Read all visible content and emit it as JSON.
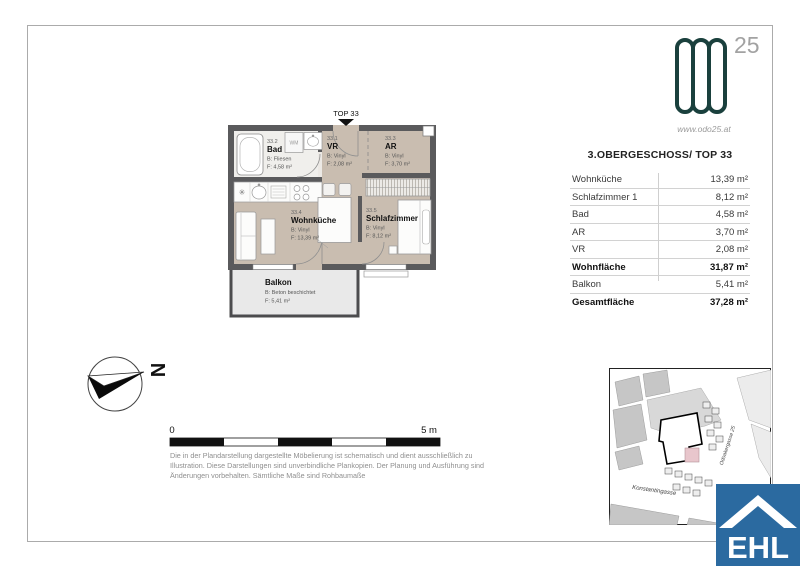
{
  "floorplan": {
    "entrance_label": "TOP 33",
    "rooms": {
      "bad": {
        "number": "33.2",
        "name": "Bad",
        "floor": "B: Fliesen",
        "area": "F: 4,58 m²"
      },
      "vr": {
        "number": "33.1",
        "name": "VR",
        "floor": "B: Vinyl",
        "area": "F: 2,08 m²"
      },
      "ar": {
        "number": "33.3",
        "name": "AR",
        "floor": "B: Vinyl",
        "area": "F: 3,70 m²"
      },
      "wohnkueche": {
        "number": "33.4",
        "name": "Wohnküche",
        "floor": "B: Vinyl",
        "area": "F: 13,39 m²"
      },
      "schlafzimmer": {
        "number": "33.5",
        "name": "Schlafzimmer",
        "floor": "B: Vinyl",
        "area": "F: 8,12 m²"
      },
      "balkon": {
        "name": "Balkon",
        "floor": "B: Beton beschichtet",
        "area": "F: 5,41 m²"
      }
    },
    "labels": {
      "wm": "WM"
    }
  },
  "brand": {
    "number": "25",
    "website": "www.odo25.at",
    "color": "#1a403d"
  },
  "area_table": {
    "title": "3.OBERGESCHOSS/ TOP 33",
    "rows": [
      {
        "name": "Wohnküche",
        "value": "13,39 m²"
      },
      {
        "name": "Schlafzimmer 1",
        "value": "8,12 m²"
      },
      {
        "name": "Bad",
        "value": "4,58 m²"
      },
      {
        "name": "AR",
        "value": "3,70 m²"
      },
      {
        "name": "VR",
        "value": "2,08 m²"
      },
      {
        "name": "Wohnfläche",
        "value": "31,87 m²"
      },
      {
        "name": "Balkon",
        "value": "5,41 m²"
      },
      {
        "name": "Gesamtfläche",
        "value": "37,28 m²"
      }
    ]
  },
  "compass": {
    "north": "N"
  },
  "scale_bar": {
    "start": "0",
    "end": "5 m"
  },
  "disclaimer": {
    "text": "Die in der Plandarstellung dargestellte Möbelierung ist schematisch und dient ausschließlich zu Illustration. Diese Darstellungen sind unverbindliche Plankopien. Der Planung und Ausführung sind Änderungen vorbehalten. Sämtliche Maße sind Rohbaumaße"
  },
  "site_map": {
    "street_side": "Odoakergasse 25",
    "street_bottom": "Konstantingasse",
    "highlight_color": "#e8c6cc"
  },
  "ehl_logo": {
    "text": "EHL",
    "color": "#2b6aa0"
  }
}
